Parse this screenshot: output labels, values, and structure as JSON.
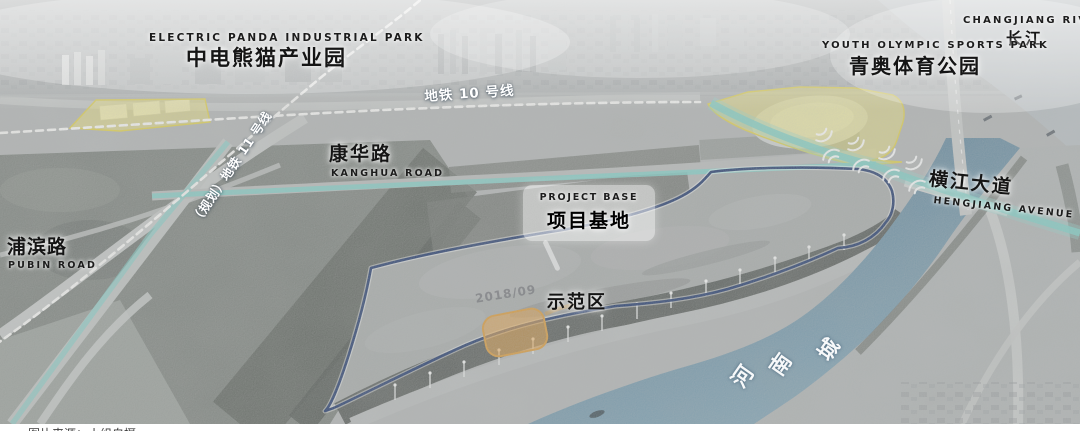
{
  "figure": {
    "type": "annotated-aerial-site-map",
    "caption": "图片来源：小组自摄",
    "watermark": "2018/09",
    "colors": {
      "boundary_navy": "#20386b",
      "boundary_halo": "rgba(255,255,255,0.45)",
      "highlight_yellow_fill": "rgba(246,233,110,0.5)",
      "highlight_yellow_stroke": "#dfd04d",
      "highlight_orange_fill": "rgba(235,163,66,0.6)",
      "highlight_orange_stroke": "#d9993a",
      "road_teal": "rgba(123,207,199,0.85)",
      "road_teal_soft": "rgba(140,215,205,0.35)",
      "metro_dash_white": "#f7f7f5",
      "river_deep": "#53788f",
      "river_light": "#7fa3b5",
      "label_black": "#151515",
      "label_white": "#ffffff"
    },
    "labels": {
      "industrial_park_en": "ELECTRIC PANDA INDUSTRIAL PARK",
      "industrial_park_zh": "中电熊猫产业园",
      "changjiang_en": "CHANGJIANG RIVER",
      "changjiang_zh": "长江",
      "sports_park_en": "YOUTH OLYMPIC SPORTS PARK",
      "sports_park_zh": "青奥体育公园",
      "metro10": "地铁 10 号线",
      "metro11": "（规划）地铁 11 号线",
      "kanghua_zh": "康华路",
      "kanghua_en": "KANGHUA ROAD",
      "pubin_zh": "浦滨路",
      "pubin_en": "PUBIN ROAD",
      "project_base_en": "PROJECT BASE",
      "project_base_zh": "项目基地",
      "demo_zone": "示范区",
      "hengjiang_zh": "横江大道",
      "hengjiang_en": "HENGJIANG AVENUE",
      "chengnan_river_chars": [
        "城",
        "南",
        "河"
      ]
    }
  }
}
